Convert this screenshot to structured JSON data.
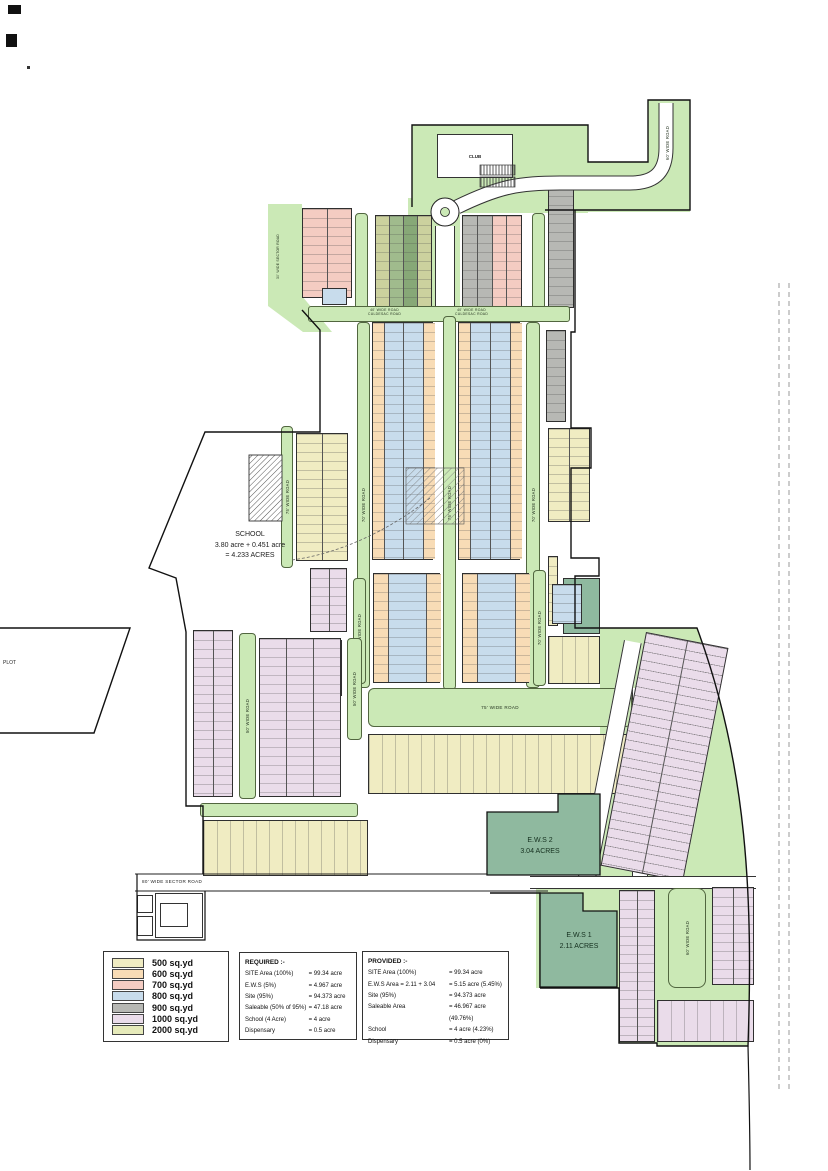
{
  "legend": {
    "items": [
      {
        "label": "500 sq.yd",
        "color": "#f0ecc2"
      },
      {
        "label": "600 sq.yd",
        "color": "#f8dcb6"
      },
      {
        "label": "700 sq.yd",
        "color": "#f4ccc2"
      },
      {
        "label": "800 sq.yd",
        "color": "#c8dcec"
      },
      {
        "label": "900 sq.yd",
        "color": "#b7b8b4"
      },
      {
        "label": "1000 sq.yd",
        "color": "#eadcea"
      },
      {
        "label": "2000 sq.yd",
        "color": "#e6eaba"
      }
    ]
  },
  "required": {
    "heading": "REQUIRED :-",
    "rows": [
      {
        "item": "SITE Area (100%)",
        "value": "= 99.34 acre"
      },
      {
        "item": "E.W.S (5%)",
        "value": "= 4.967 acre"
      },
      {
        "item": "Site  (95%)",
        "value": "= 94.373 acre"
      },
      {
        "item": "Saleable  (50% of 95%)",
        "value": "= 47.18 acre"
      },
      {
        "item": "School   (4 Acre)",
        "value": "= 4 acre"
      },
      {
        "item": "Dispensary",
        "value": "= 0.5 acre"
      }
    ]
  },
  "provided": {
    "heading": "PROVIDED :-",
    "rows": [
      {
        "item": "SITE Area (100%)",
        "value": "= 99.34 acre"
      },
      {
        "item": "E.W.S Area = 2.11 + 3.04",
        "value": "= 5.15 acre (5.45%)"
      },
      {
        "item": "Site  (95%)",
        "value": "= 94.373 acre"
      },
      {
        "item": "Saleable Area",
        "value": "= 46.967 acre (49.76%)"
      },
      {
        "item": "School",
        "value": "= 4 acre (4.23%)"
      },
      {
        "item": "Dispensary",
        "value": "= 0.5 acre (0%)"
      }
    ]
  },
  "labels": {
    "club": "CLUB",
    "school_line1": "SCHOOL",
    "school_line2": "3.80 acre + 0.451 acre",
    "school_line3": "= 4.233 ACRES",
    "ews2_line1": "E.W.S 2",
    "ews2_line2": "3.04 ACRES",
    "ews1_line1": "E.W.S 1",
    "ews1_line2": "2.11 ACRES",
    "plot": "PLOT"
  },
  "roads": {
    "r30sector": "30' WIDE SECTOR ROAD",
    "r40": "40' WIDE ROAD",
    "culdesac": "CULDESAC ROAD",
    "r50": "50' WIDE ROAD",
    "r60": "60' WIDE ROAD",
    "r70": "70' WIDE ROAD",
    "r75": "75' WIDE ROAD",
    "r80sector": "80' WIDE SECTOR ROAD"
  },
  "colors": {
    "road_green": "#cbe9b6",
    "ews_green": "#8fb99f"
  }
}
